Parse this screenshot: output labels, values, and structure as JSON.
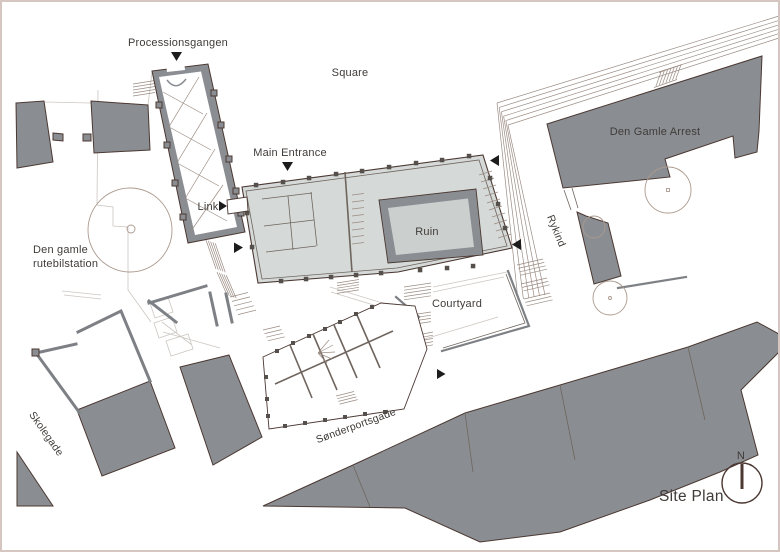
{
  "labels": {
    "processionsgangen": "Processionsgangen",
    "square": "Square",
    "main_entrance": "Main Entrance",
    "link": "Link",
    "rutebilstation_line1": "Den gamle",
    "rutebilstation_line2": "rutebilstation",
    "arrest": "Den Gamle Arrest",
    "rykind": "Rykind",
    "ruin": "Ruin",
    "courtyard": "Courtyard",
    "skolegade": "Skolegade",
    "sonderportsgade": "Sønderportsgade",
    "site_plan": "Site Plan",
    "north": "N"
  },
  "colors": {
    "building_dark": "#8a8e92",
    "outline": "#4b3832",
    "museum_fill": "#d5d9d8",
    "ruin_floor": "#cbd0cf",
    "wall": "#7d8084",
    "column": "#55504b",
    "detail": "#6f655e",
    "ground_line": "#ccc6c1",
    "step_line": "#9b8c83",
    "tree_stroke": "#ab9a8f",
    "arrow": "#1c1c1c",
    "text": "#3f3b38",
    "border": "#d6c6c2"
  }
}
